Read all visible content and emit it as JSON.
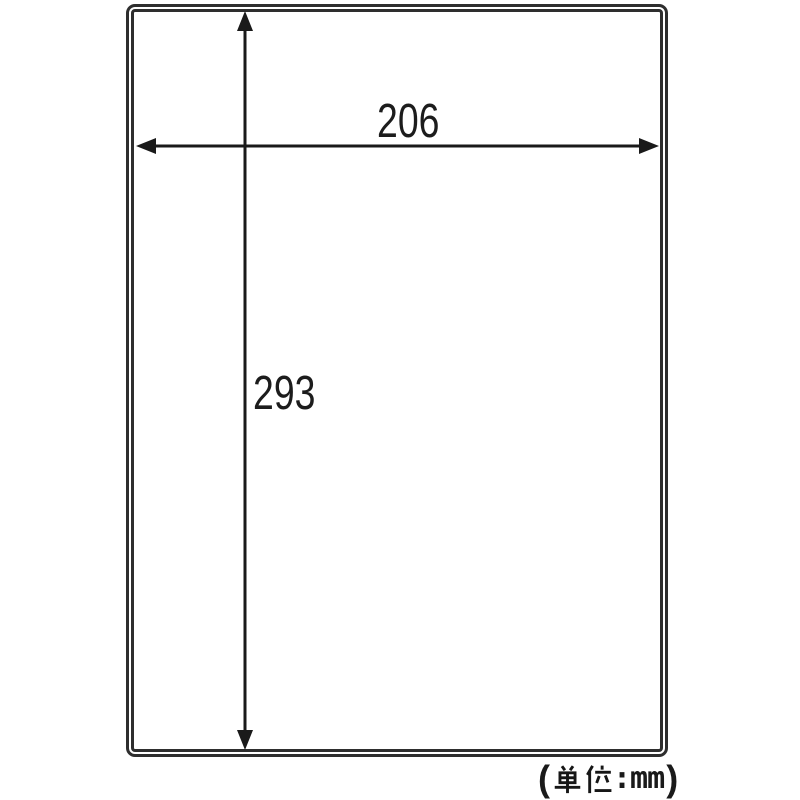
{
  "diagram": {
    "kind": "sheet-dimension-drawing",
    "sheet_outline_color": "#2e2e2e",
    "dimension_line_color": "#1a1a1a",
    "width_label": "206",
    "height_label": "293",
    "unit_note": {
      "text": "（単位:mm）",
      "open_paren": "(",
      "kanji": "単位",
      "colon_and_unit": ":mm",
      "close_paren": ")"
    }
  }
}
